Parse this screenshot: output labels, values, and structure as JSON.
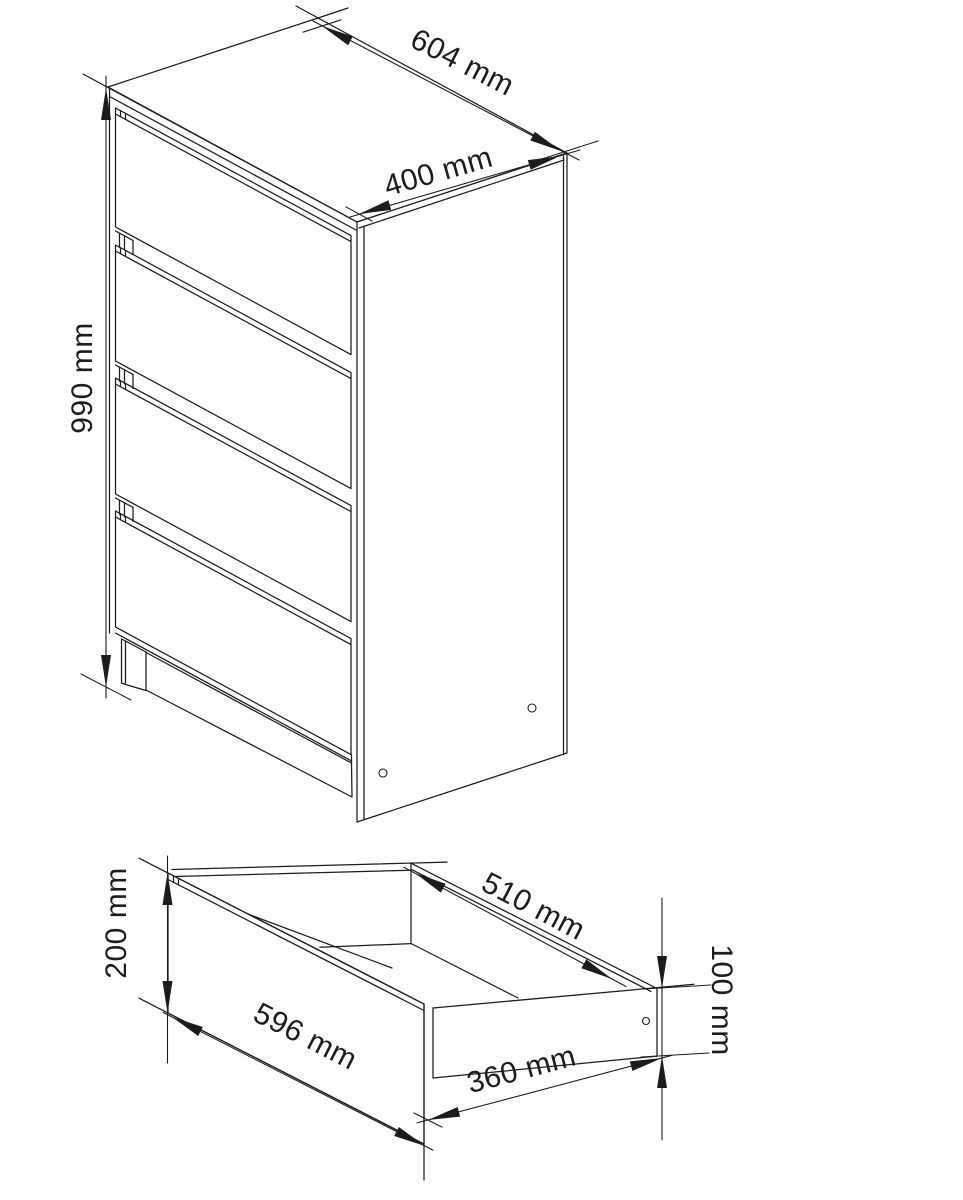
{
  "drawing": {
    "background_color": "#ffffff",
    "line_color": "#1c1c1c",
    "cabinet_view": {
      "dim_width": "604 mm",
      "dim_depth": "400 mm",
      "dim_height": "990 mm"
    },
    "drawer_view": {
      "dim_front_width": "596 mm",
      "dim_front_height": "200 mm",
      "dim_inner_depth": "510 mm",
      "dim_side_length": "360 mm",
      "dim_side_height": "100 mm"
    }
  }
}
